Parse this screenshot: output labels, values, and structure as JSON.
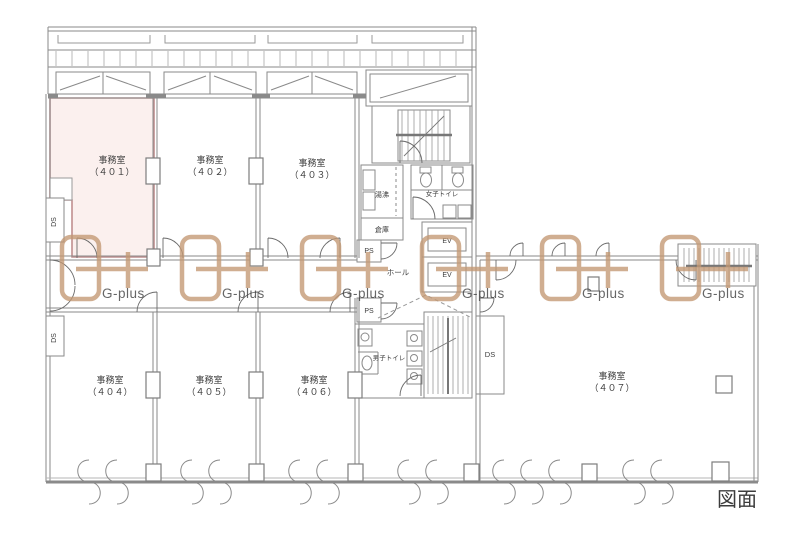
{
  "canvas": {
    "width": 800,
    "height": 534,
    "background": "#ffffff"
  },
  "caption": "図面",
  "watermark": {
    "text": "G-plus",
    "color": "#c39873"
  },
  "highlight": {
    "room": "401",
    "fill": "#fbf0ee",
    "stroke": "#c18f8f"
  },
  "rooms": [
    {
      "name": "事務室",
      "number": "（４０１）"
    },
    {
      "name": "事務室",
      "number": "（４０２）"
    },
    {
      "name": "事務室",
      "number": "（４０３）"
    },
    {
      "name": "事務室",
      "number": "（４０４）"
    },
    {
      "name": "事務室",
      "number": "（４０５）"
    },
    {
      "name": "事務室",
      "number": "（４０６）"
    },
    {
      "name": "事務室",
      "number": "（４０７）"
    }
  ],
  "labels": {
    "hot_water": "湯沸",
    "storage": "倉庫",
    "womens_toilet": "女子トイレ",
    "mens_toilet": "男子トイレ",
    "hall": "ホール",
    "elevator": "EV",
    "pipe_shaft": "PS",
    "duct_space": "DS"
  }
}
